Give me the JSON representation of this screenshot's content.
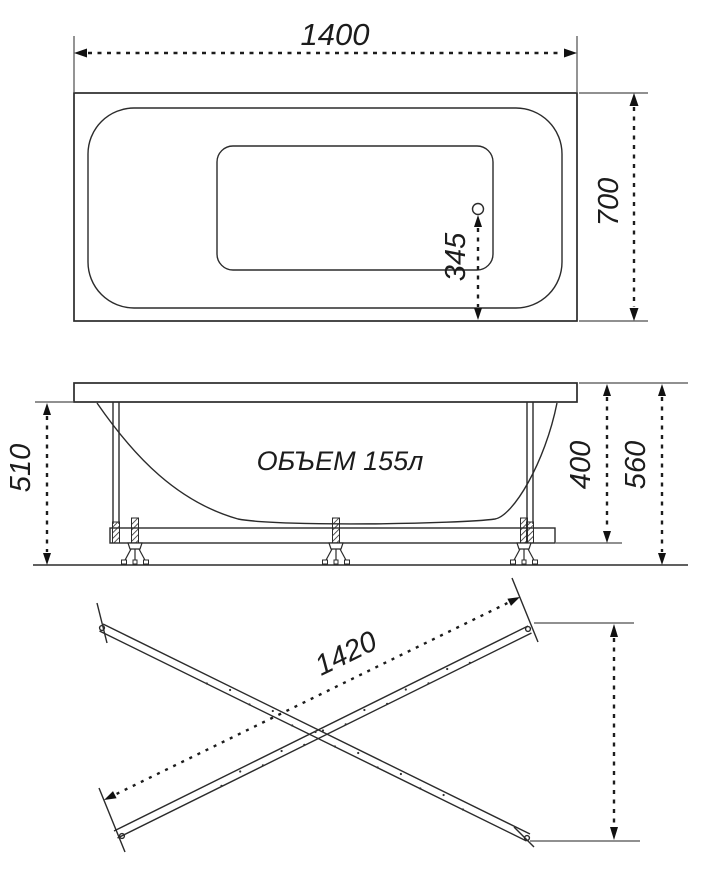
{
  "colors": {
    "background": "#ffffff",
    "line": "#2b2b2b",
    "dimension": "#1c1c1c",
    "extension": "#4d4d4d"
  },
  "top_view": {
    "length_label": "1400",
    "width_label": "700",
    "drain_offset_label": "345"
  },
  "side_view": {
    "volume_label": "ОБЪЕМ 155л",
    "rim_to_floor_label": "510",
    "rim_to_frame_label": "400",
    "total_height_label": "560"
  },
  "rails_view": {
    "rail_length_label": "1420"
  }
}
